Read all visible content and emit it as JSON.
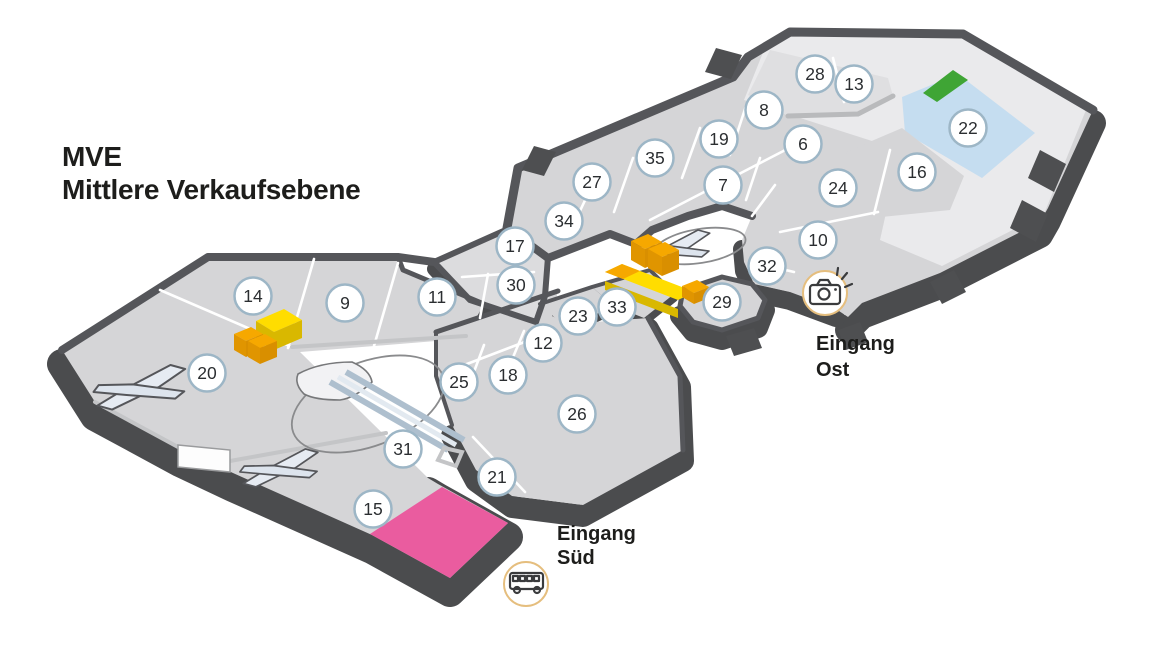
{
  "title": {
    "line1": "MVE",
    "line2": "Mittlere Verkaufsebene"
  },
  "map": {
    "units": [
      {
        "n": "6",
        "x": 803,
        "y": 144
      },
      {
        "n": "7",
        "x": 723,
        "y": 185
      },
      {
        "n": "8",
        "x": 764,
        "y": 110
      },
      {
        "n": "9",
        "x": 345,
        "y": 303
      },
      {
        "n": "10",
        "x": 818,
        "y": 240
      },
      {
        "n": "11",
        "x": 437,
        "y": 297
      },
      {
        "n": "12",
        "x": 543,
        "y": 343
      },
      {
        "n": "13",
        "x": 854,
        "y": 84
      },
      {
        "n": "14",
        "x": 253,
        "y": 296
      },
      {
        "n": "15",
        "x": 373,
        "y": 509
      },
      {
        "n": "16",
        "x": 917,
        "y": 172
      },
      {
        "n": "17",
        "x": 515,
        "y": 246
      },
      {
        "n": "18",
        "x": 508,
        "y": 375
      },
      {
        "n": "19",
        "x": 719,
        "y": 139
      },
      {
        "n": "20",
        "x": 207,
        "y": 373
      },
      {
        "n": "21",
        "x": 497,
        "y": 477
      },
      {
        "n": "22",
        "x": 968,
        "y": 128
      },
      {
        "n": "23",
        "x": 578,
        "y": 316
      },
      {
        "n": "24",
        "x": 838,
        "y": 188
      },
      {
        "n": "25",
        "x": 459,
        "y": 382
      },
      {
        "n": "26",
        "x": 577,
        "y": 414
      },
      {
        "n": "27",
        "x": 592,
        "y": 182
      },
      {
        "n": "28",
        "x": 815,
        "y": 74
      },
      {
        "n": "29",
        "x": 722,
        "y": 302
      },
      {
        "n": "30",
        "x": 516,
        "y": 285
      },
      {
        "n": "31",
        "x": 403,
        "y": 449
      },
      {
        "n": "32",
        "x": 767,
        "y": 266
      },
      {
        "n": "33",
        "x": 617,
        "y": 307
      },
      {
        "n": "34",
        "x": 564,
        "y": 221
      },
      {
        "n": "35",
        "x": 655,
        "y": 158
      }
    ],
    "entrances": [
      {
        "id": "ost",
        "line1": "Eingang",
        "line2": "Ost",
        "icon": "camera-flash-icon"
      },
      {
        "id": "sued",
        "line1": "Eingang",
        "line2": "Süd",
        "icon": "bus-icon"
      }
    ],
    "colors": {
      "accent_pink": "#EA5C9F",
      "accent_green": "#3FA535",
      "accent_blue": "#C5DDF0",
      "accent_yellow": "#FFDD00",
      "accent_yellow_dark": "#D9B800",
      "accent_orange": "#F6A800",
      "accent_orange_mid": "#E09500",
      "accent_orange_dark": "#D98F00",
      "circle_stroke": "#9DB6C6",
      "entrance_ring": "#E5BE7E",
      "number_color": "#2B2E31",
      "label_color": "#1D1D1B",
      "icon_color": "#3A3B3D"
    }
  }
}
